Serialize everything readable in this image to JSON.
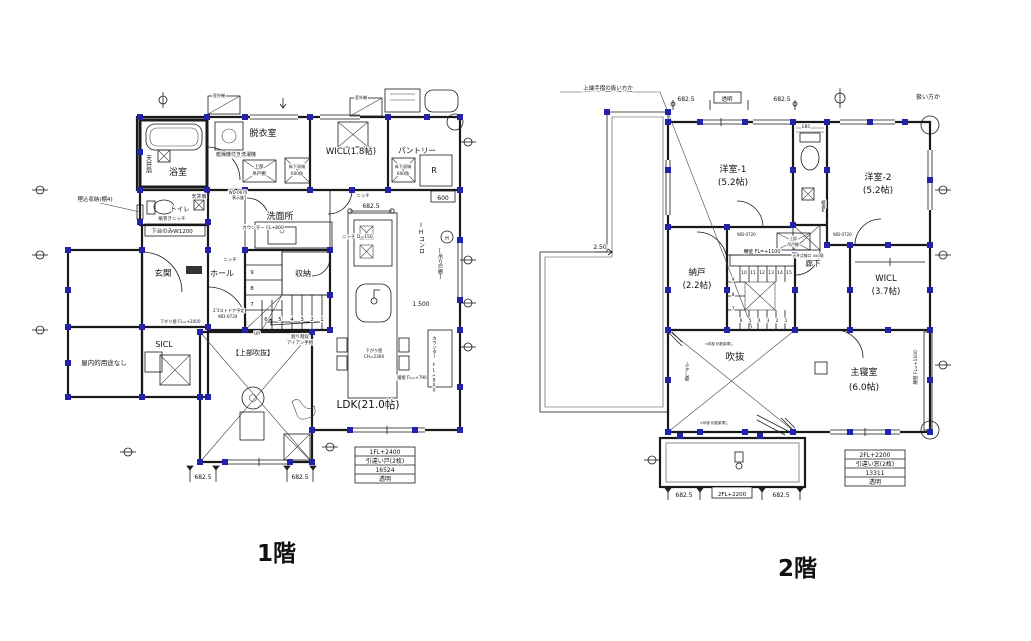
{
  "floor1": {
    "caption": "1階",
    "rooms": {
      "bath": "浴室",
      "dressing": "脱衣室",
      "wicl": "WICL(1.8帖)",
      "pantry": "パントリー",
      "toilet": "トイレ",
      "washroom": "洗面所",
      "entrance": "玄関",
      "hall": "ホール",
      "storage": "収納",
      "sicl": "SICL",
      "no_use": "屋内的用途なし",
      "upper_void": "【上部吹抜】",
      "ldk": "LDK(21.0帖)"
    },
    "notes": {
      "ceiling_fan": "天井扇",
      "washer": "乾燥機付き洗濯機",
      "upper_cabinet_1": "上部",
      "upper_cabinet_2": "吊戸棚",
      "floor_storage_1": "床下収納",
      "floor_storage_2": "600角",
      "outdoor_unit": "室外機",
      "recessed_storage": "埋込収納(棚4)",
      "paper_niche": "紙巻きニッチ",
      "lower_cabinet": "下台のみW1200",
      "hanging_wall_entrance": "下がり壁 FL=+2000",
      "door_plan_1": "2'3ストドア予定",
      "door_plan_2": "WD-0724",
      "door_lock_1": "WD-0670",
      "door_lock_2": "表示錠",
      "counter_800": "カウンター FL+800",
      "niche_d150": "ニッチ D=150",
      "niche": "ニッチ",
      "ih_stove": "IHコンロ",
      "hood": "H",
      "hanging_shelf": "[吊り戸棚]",
      "low_wall_790": "腰壁 FL=+790",
      "hanging_wall_kitchen_1": "下がり壁",
      "hanging_wall_kitchen_2": "CH=2300",
      "stair_note_1": "廻り階段",
      "stair_note_2": "アイアン手摺",
      "up": "UP",
      "fridge": "R"
    },
    "dims": {
      "d682": "682.5",
      "d600": "600",
      "d1500": "1.500"
    },
    "stairs": [
      "1",
      "2",
      "3",
      "4",
      "5",
      "6",
      "7",
      "8",
      "9"
    ],
    "window_table": [
      "1FL+2400",
      "引違い戸(2枚)",
      "16524",
      "透明"
    ]
  },
  "floor2": {
    "caption": "2階",
    "rooms": {
      "west1_a": "洋室-1",
      "west1_b": "(5.2帖)",
      "west2_a": "洋室-2",
      "west2_b": "(5.2帖)",
      "nando_a": "納戸",
      "nando_b": "(2.2帖)",
      "corridor": "廊下",
      "wicl_a": "WICL",
      "wicl_b": "(3.7帖)",
      "void": "吹抜",
      "master_a": "主寝室",
      "master_b": "(6.0帖)"
    },
    "notes": {
      "low_wall_1100": "腰壁 FL=+1100",
      "door_wd0720": "WD-0720",
      "eb5": "EB5",
      "paper_holder": "紙巻K",
      "inspection": "天井点検口 450角",
      "upper_cabinet_1": "上部",
      "upper_cabinet_2": "吊戸棚",
      "fukashi_wall": "ふかし壁",
      "x_note": "×印部 化粧梁現し",
      "slope": "2.50",
      "leader_note": "上端手摺の扱い方か",
      "handling_note": "扱い方か",
      "clear": "透明",
      "fl2200": "2FL+2200"
    },
    "dims": {
      "d682": "682.5"
    },
    "stairs": [
      "1",
      "2",
      "3",
      "4",
      "5",
      "6",
      "7",
      "8",
      "9",
      "10",
      "11",
      "12",
      "13",
      "14",
      "15"
    ],
    "window_table": [
      "2FL+2200",
      "引違い窓(2枚)",
      "13311",
      "透明"
    ]
  }
}
